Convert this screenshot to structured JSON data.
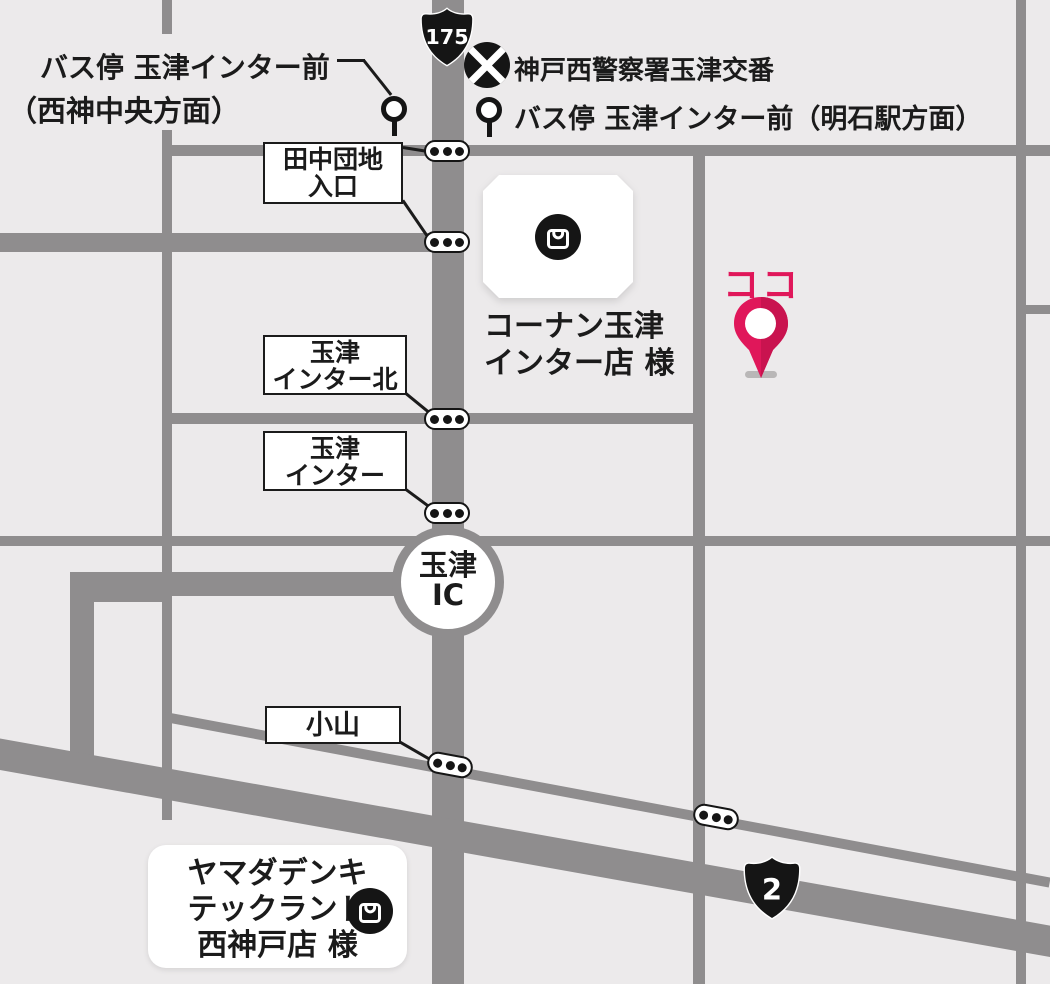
{
  "colors": {
    "background": "#ECEAEB",
    "road": "#8F8D8E",
    "ink": "#1B1B1B",
    "here_pink": "#E0175A"
  },
  "shields": {
    "route175": "175",
    "route2": "2"
  },
  "legend": {
    "bus_stop_west_line1": "バス停 玉津インター前",
    "bus_stop_west_line2": "（西神中央方面）",
    "police_station": "神戸西警察署玉津交番",
    "bus_stop_east": "バス停 玉津インター前（明石駅方面）"
  },
  "intersections": [
    {
      "id": "tanaka-danchi-iriguchi",
      "line1": "田中団地",
      "line2": "入口"
    },
    {
      "id": "tamatsu-inter-kita",
      "line1": "玉津",
      "line2": "インター北"
    },
    {
      "id": "tamatsu-inter",
      "line1": "玉津",
      "line2": "インター"
    },
    {
      "id": "koyama",
      "line1": "小山"
    }
  ],
  "interchange": {
    "line1": "玉津",
    "line2": "IC"
  },
  "pois": {
    "konan": {
      "line1": "コーナン玉津",
      "line2": "インター店 様"
    },
    "yamada": {
      "line1": "ヤマダデンキ",
      "line2": "テックランド",
      "line3": "西神戸店 様"
    }
  },
  "here_marker": {
    "label": "ココ"
  }
}
